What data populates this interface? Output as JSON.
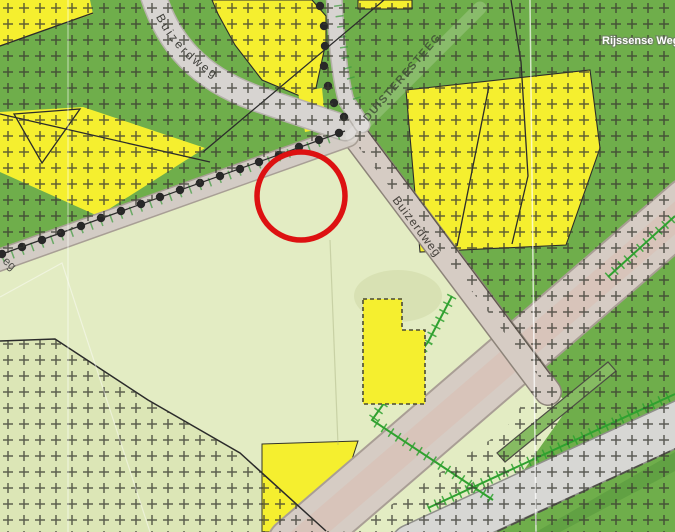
{
  "title": "Topographic zoning map with red circle annotation",
  "map": {
    "labels": {
      "buizerdweg_top": "Buizerdweg",
      "buizerdweg_mid": "Buizerdweg",
      "duisteresteeg": "DUISTERESTEEG",
      "rijssense_weg": "Rijssense Weg",
      "road_fragment": "eg"
    },
    "colors": {
      "forest_green": "#6fae4b",
      "field_pale": "#e3ecc3",
      "field_pale_dim": "#dce6b6",
      "parcel_yellow": "#f5ef2f",
      "road_gray": "#d7d4d1",
      "road_beige": "#d6ccc4",
      "road_pink": "#d8c4ba",
      "road_gray_wide": "#d7d7d4",
      "hedge_green": "#2fa12f",
      "ditch_green": "#86bb62",
      "dark_green_band": "#61a143",
      "hatch_dark": "#3a3a32",
      "tree_dot": "#282828",
      "annotation_red": "#dd1111",
      "boundary_black": "#2b2b2b"
    },
    "annotation_circle": {
      "cx": 301,
      "cy": 196,
      "r": 44,
      "stroke_width": 5.5
    }
  }
}
